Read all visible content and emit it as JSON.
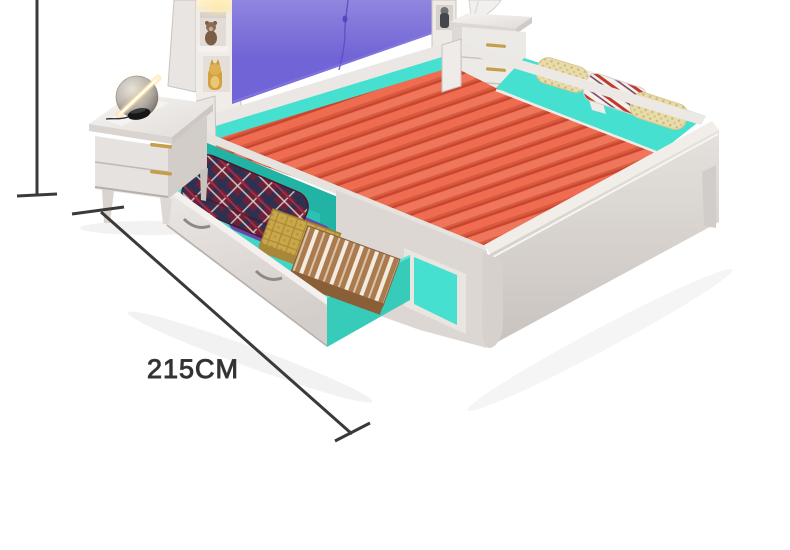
{
  "scene": {
    "type": "furniture-product-photo",
    "background": "#ffffff",
    "objects": [
      "bed-frame",
      "slatted-bed-base",
      "pull-out-storage-drawer",
      "side-storage-compartment",
      "turquoise-side-panel",
      "footboard",
      "purple-upholstered-headboard",
      "headboard-shelf",
      "teddy-bear-figurine",
      "lucky-cat-figurine",
      "toy-figurine",
      "led-shelf-light",
      "left-nightstand",
      "table-lamp",
      "right-nightstand",
      "vase",
      "plaid-folded-clothes",
      "purple-folded-clothes",
      "gold-gift-box",
      "brown-striped-box",
      "knit-blanket",
      "striped-blanket"
    ]
  },
  "dimension_annotation": {
    "length_label": "215CM",
    "line_color": "#3a3a3a",
    "text_color": "#2f2f2f"
  },
  "colors": {
    "slat_orange": "#ef6c51",
    "slat_gap_red": "#c8462f",
    "storage_teal": "#45e0cf",
    "cavity_teal_dark": "#21b3a3",
    "headboard_purple": "#7164d6",
    "frame_white": "#e7e3e0",
    "handle_gold": "#c59e4a",
    "plaid_maroon": "#6e2038",
    "plaid_navy": "#2a3152",
    "box_gold": "#c9a84c",
    "box_brown": "#ab7b4e",
    "clothes_purple": "#6b46a8",
    "lamp_glow": "#fff3cf"
  }
}
